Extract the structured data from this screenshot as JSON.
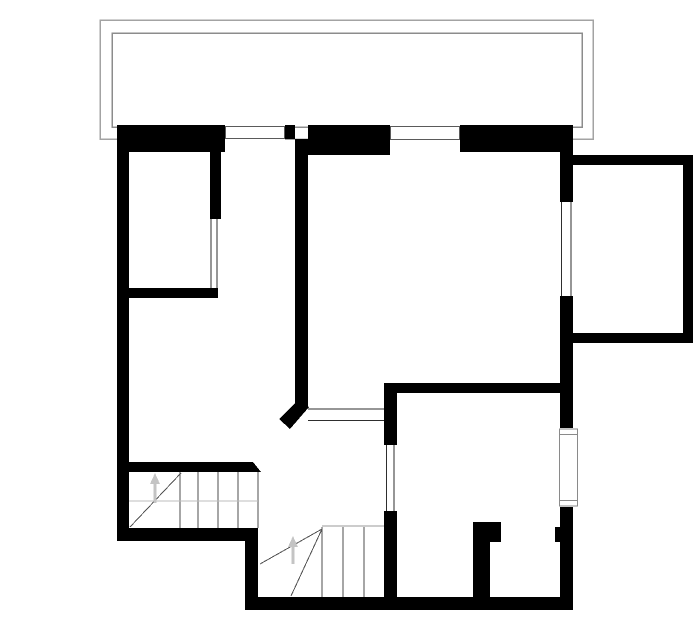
{
  "floor_plan": {
    "canvas": {
      "width": 700,
      "height": 644,
      "background": "#ffffff"
    },
    "colors": {
      "wall": "#000000",
      "balcony_outline": "#a3a3a3",
      "balcony_inner_outline": "#8c8c8c",
      "window_frame": "#5a5a5a",
      "side_window_frame": "#8a8a8a",
      "opening_line": "#2e2e2e",
      "tread_line": "#4d4d4d",
      "faint_line": "#bdbdbd",
      "stair_edge_line": "#9a9a9a",
      "diagonal_line": "#545454",
      "arrow": "#c4c4c4"
    },
    "balcony": {
      "outer_rect": [
        100,
        20,
        493,
        119
      ],
      "inner_rect": [
        112,
        33,
        470,
        94
      ]
    },
    "window_gaps": [
      {
        "name": "front-window-gap-1",
        "rect": [
          225,
          124,
          60,
          29
        ]
      },
      {
        "name": "front-window-gap-2",
        "rect": [
          390,
          124,
          70,
          32
        ]
      }
    ],
    "walls": [
      {
        "name": "front-wall-left",
        "rect": [
          117,
          125,
          108,
          27
        ]
      },
      {
        "name": "front-wall-mullion",
        "rect": [
          285,
          125,
          10,
          14
        ]
      },
      {
        "name": "front-wall-center",
        "rect": [
          308,
          125,
          82,
          30
        ]
      },
      {
        "name": "front-wall-right",
        "rect": [
          460,
          125,
          113,
          27
        ]
      },
      {
        "name": "left-exterior-wall",
        "rect": [
          117,
          125,
          12,
          416
        ]
      },
      {
        "name": "right-exterior-wall-upper",
        "rect": [
          560,
          125,
          13,
          77
        ]
      },
      {
        "name": "right-exterior-wall-middle",
        "rect": [
          560,
          296,
          13,
          132
        ]
      },
      {
        "name": "right-exterior-wall-lower",
        "rect": [
          560,
          507,
          13,
          103
        ]
      },
      {
        "name": "right-wall-door-jamb",
        "rect": [
          555,
          527,
          18,
          15
        ]
      },
      {
        "name": "annex-top-wall",
        "rect": [
          560,
          155,
          133,
          10
        ]
      },
      {
        "name": "annex-right-wall",
        "rect": [
          683,
          155,
          10,
          188
        ]
      },
      {
        "name": "annex-bottom-wall",
        "rect": [
          560,
          333,
          133,
          10
        ]
      },
      {
        "name": "upper-left-room-divider-wall",
        "rect": [
          210,
          139,
          11,
          80
        ]
      },
      {
        "name": "upper-left-room-bottom-wall",
        "rect": [
          129,
          288,
          89,
          10
        ]
      },
      {
        "name": "central-partition-wall",
        "rect": [
          295,
          139,
          13,
          269
        ]
      },
      {
        "name": "lower-right-room-top-wall",
        "rect": [
          384,
          383,
          189,
          10
        ]
      },
      {
        "name": "lower-right-room-left-wall-upper",
        "rect": [
          384,
          383,
          13,
          62
        ]
      },
      {
        "name": "lower-right-room-left-wall-lower",
        "rect": [
          384,
          511,
          13,
          99
        ]
      },
      {
        "name": "stair-top-wall",
        "rect": [
          129,
          462,
          118,
          10
        ]
      },
      {
        "name": "stair-bottom-wall",
        "rect": [
          117,
          528,
          141,
          13
        ]
      },
      {
        "name": "stair-side-wall",
        "rect": [
          245,
          528,
          13,
          82
        ]
      },
      {
        "name": "bottom-exterior-wall",
        "rect": [
          245,
          597,
          328,
          13
        ]
      },
      {
        "name": "wc-partition-wall",
        "rect": [
          473,
          522,
          17,
          88
        ]
      },
      {
        "name": "wc-partition-jamb",
        "rect": [
          490,
          522,
          11,
          20
        ]
      }
    ],
    "wall_bevels": [
      {
        "name": "stair-top-wall-bevel",
        "points": "247,462 253,462 261,472 247,472"
      },
      {
        "name": "central-wall-end-bevel",
        "points": "296,402 309,407 290,429 279,419"
      }
    ],
    "window_frames": [
      {
        "name": "front-window-1",
        "rect": [
          225.5,
          126.5,
          59,
          12
        ],
        "stroke": "window_frame"
      },
      {
        "name": "front-window-2",
        "rect": [
          390.5,
          126.5,
          69,
          13
        ],
        "stroke": "window_frame"
      },
      {
        "name": "side-window",
        "rect": [
          559.5,
          429,
          18,
          77
        ],
        "stroke": "side_window_frame"
      }
    ],
    "window_cap_lines": [
      {
        "name": "side-window-cap-top",
        "line": [
          559.5,
          434.5,
          577.5,
          434.5
        ],
        "stroke": "side_window_frame"
      },
      {
        "name": "side-window-cap-bottom",
        "line": [
          559.5,
          500.5,
          577.5,
          500.5
        ],
        "stroke": "side_window_frame"
      }
    ],
    "opening_lines": [
      {
        "name": "upper-room-door-line-left",
        "line": [
          211,
          219,
          211,
          288
        ]
      },
      {
        "name": "upper-room-door-line-right",
        "line": [
          217,
          219,
          217,
          288
        ]
      },
      {
        "name": "annex-opening-line-left",
        "line": [
          561.5,
          202,
          561.5,
          296
        ]
      },
      {
        "name": "annex-opening-line-right",
        "line": [
          571,
          202,
          571,
          296
        ]
      },
      {
        "name": "hall-passage-line-top",
        "line": [
          308,
          409,
          384,
          409
        ]
      },
      {
        "name": "hall-passage-line-bottom",
        "line": [
          308,
          420.5,
          384,
          420.5
        ]
      },
      {
        "name": "lower-room-door-line-left",
        "line": [
          386.5,
          445,
          386.5,
          511
        ]
      },
      {
        "name": "lower-room-door-line-right",
        "line": [
          394,
          445,
          394,
          511
        ]
      }
    ],
    "stairs": {
      "upper_flight": {
        "tread_lines": [
          [
            180,
            472,
            180,
            528
          ],
          [
            198,
            472,
            198,
            528
          ],
          [
            218,
            472,
            218,
            528
          ],
          [
            238,
            472,
            238,
            528
          ],
          [
            258,
            472,
            258,
            528
          ]
        ],
        "faint_lines": [
          [
            129,
            501,
            258,
            501
          ]
        ],
        "diagonal_lines": [
          [
            130,
            527,
            181,
            473
          ]
        ]
      },
      "lower_flight": {
        "edge_lines": [
          [
            322,
            526,
            384,
            526
          ]
        ],
        "tread_lines": [
          [
            322,
            527,
            322,
            597
          ],
          [
            343,
            527,
            343,
            597
          ],
          [
            364,
            527,
            364,
            597
          ]
        ],
        "diagonal_lines": [
          [
            322,
            529,
            260,
            564
          ],
          [
            322,
            529,
            291,
            596
          ]
        ]
      }
    },
    "direction_arrows": [
      {
        "name": "upper-stair-direction-arrow",
        "shaft": [
          155,
          503,
          155,
          482
        ],
        "head": "150,484 160,484 155,473"
      },
      {
        "name": "lower-stair-direction-arrow",
        "shaft": [
          293,
          564,
          293,
          545
        ],
        "head": "288,547 298,547 293,536"
      }
    ]
  }
}
